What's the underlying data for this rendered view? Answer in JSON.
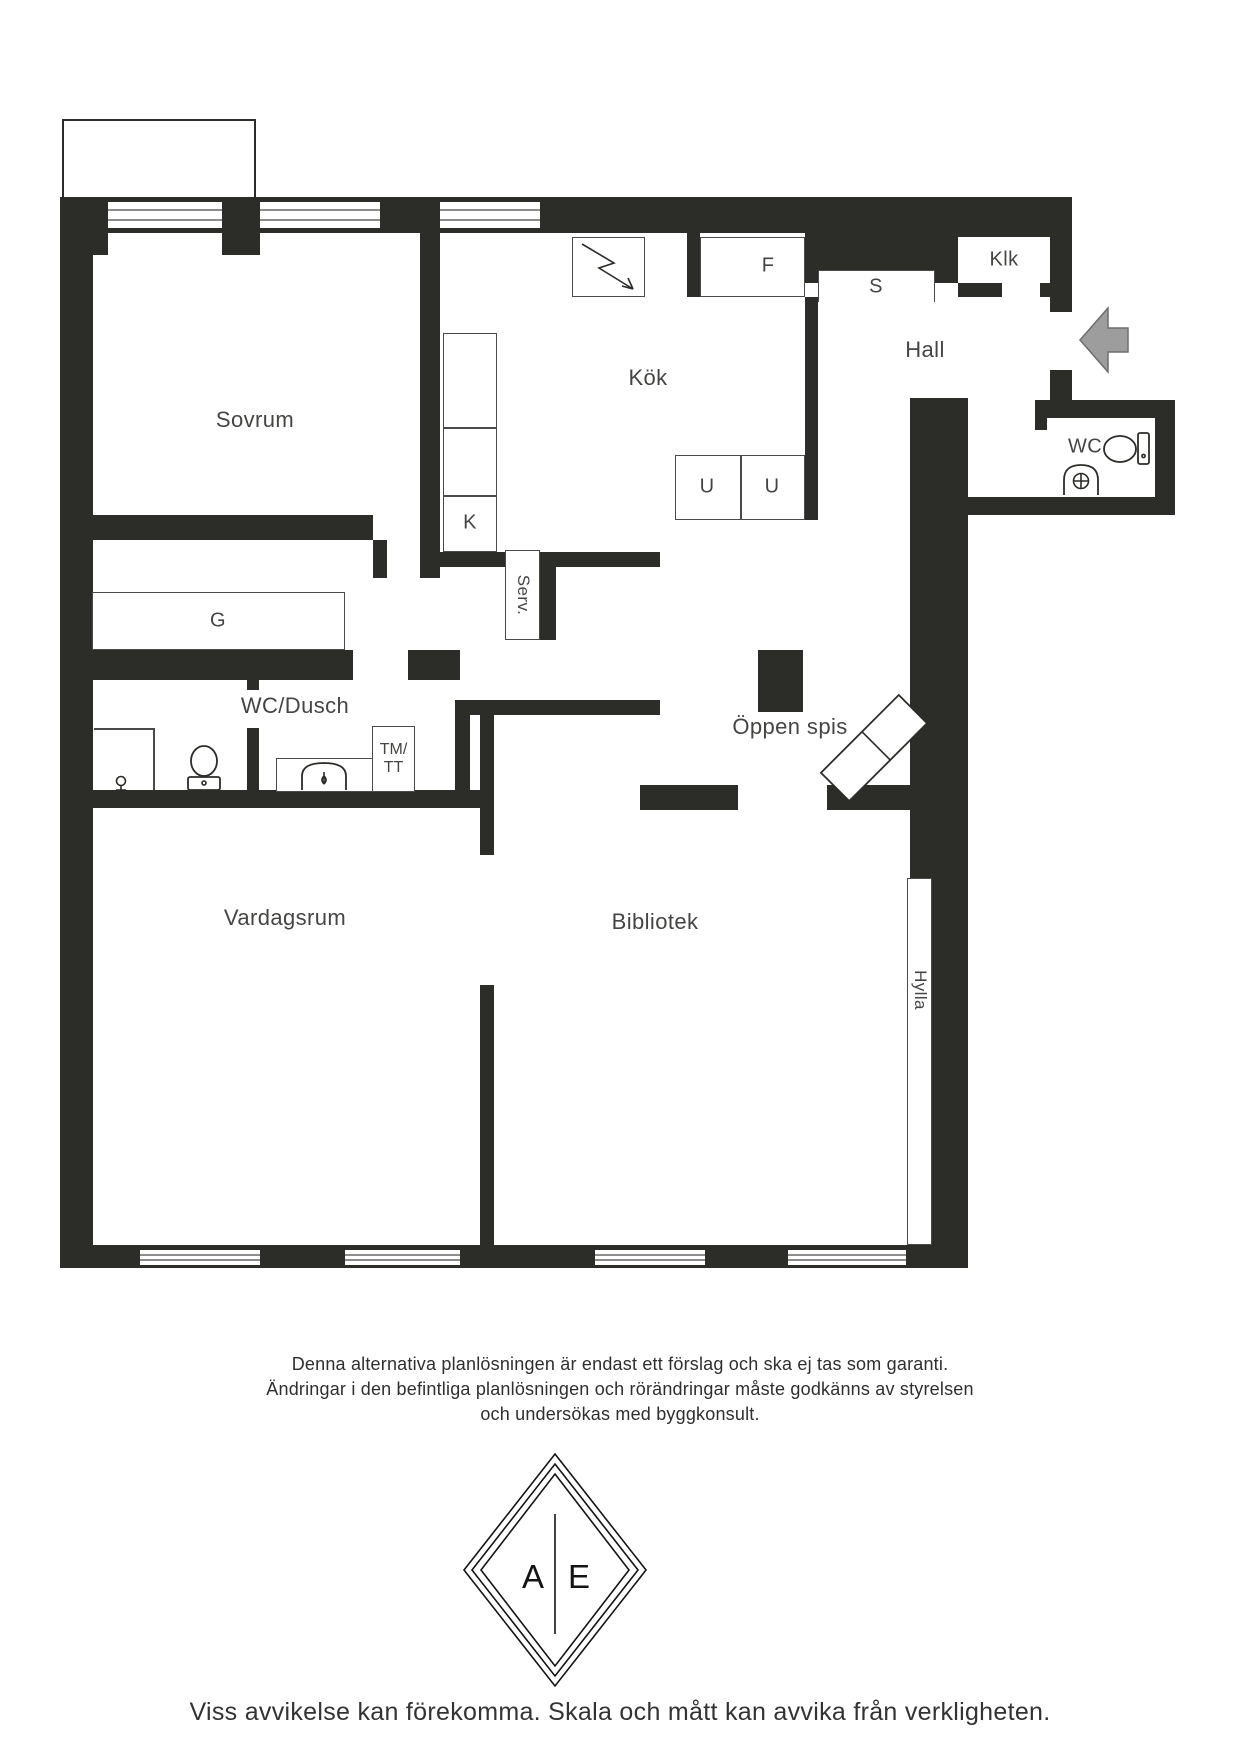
{
  "floorplan": {
    "rooms": {
      "sovrum": {
        "label": "Sovrum"
      },
      "kok": {
        "label": "Kök"
      },
      "hall": {
        "label": "Hall"
      },
      "klk": {
        "label": "Klk"
      },
      "wc": {
        "label": "WC"
      },
      "wc_dusch": {
        "label": "WC/Dusch"
      },
      "oppen_spis": {
        "label": "Öppen spis"
      },
      "vardagsrum": {
        "label": "Vardagsrum"
      },
      "bibliotek": {
        "label": "Bibliotek"
      }
    },
    "fixtures": {
      "f": "F",
      "s": "S",
      "u1": "U",
      "u2": "U",
      "k": "K",
      "g": "G",
      "serv": "Serv.",
      "hylla": "Hylla",
      "tm_line1": "TM/",
      "tm_line2": "TT"
    },
    "colors": {
      "wall": "#2c2c28",
      "arrow": "#9d9d9d",
      "line": "#4a4a4a",
      "text": "#454543"
    }
  },
  "disclaimer": {
    "line1": "Denna alternativa planlösningen är endast ett förslag och ska ej tas som garanti.",
    "line2": "Ändringar i den befintliga planlösningen och rörändringar måste godkänns av styrelsen",
    "line3": "och undersökas med byggkonsult."
  },
  "logo": {
    "left": "A",
    "right": "E"
  },
  "footer": {
    "text": "Viss avvikelse kan förekomma. Skala och mått kan avvika från verkligheten."
  }
}
